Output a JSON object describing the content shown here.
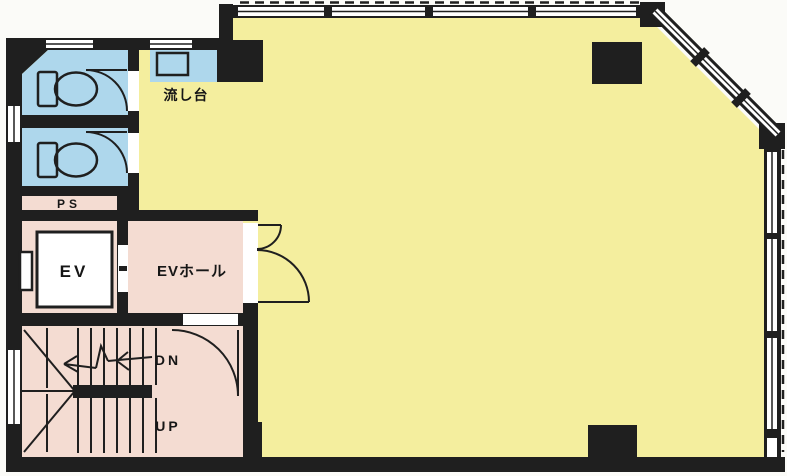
{
  "labels": {
    "sink": "流し台",
    "pipe_shaft": "PS",
    "elevator": "EV",
    "elevator_hall": "EVホール",
    "stair_down": "DN",
    "stair_up": "UP"
  },
  "colors": {
    "wall": "#1f1f1f",
    "main_room": "#f4ee9e",
    "wet_area": "#aed7ec",
    "service_area": "#f4dcd2",
    "opening": "#ffffff",
    "paper": "#fbfbf8"
  },
  "rooms": [
    {
      "id": "main-room",
      "use": "office floor",
      "color_key": "main_room"
    },
    {
      "id": "toilet-1",
      "use": "WC",
      "color_key": "wet_area"
    },
    {
      "id": "toilet-2",
      "use": "WC",
      "color_key": "wet_area"
    },
    {
      "id": "sink-counter",
      "use": "流し台",
      "color_key": "wet_area"
    },
    {
      "id": "pipe-shaft",
      "use": "PS",
      "color_key": "service_area"
    },
    {
      "id": "elevator",
      "use": "EV",
      "color_key": "service_area"
    },
    {
      "id": "elevator-hall",
      "use": "EVホール",
      "color_key": "service_area"
    },
    {
      "id": "stairwell",
      "use": "DN / UP",
      "color_key": "service_area"
    }
  ]
}
